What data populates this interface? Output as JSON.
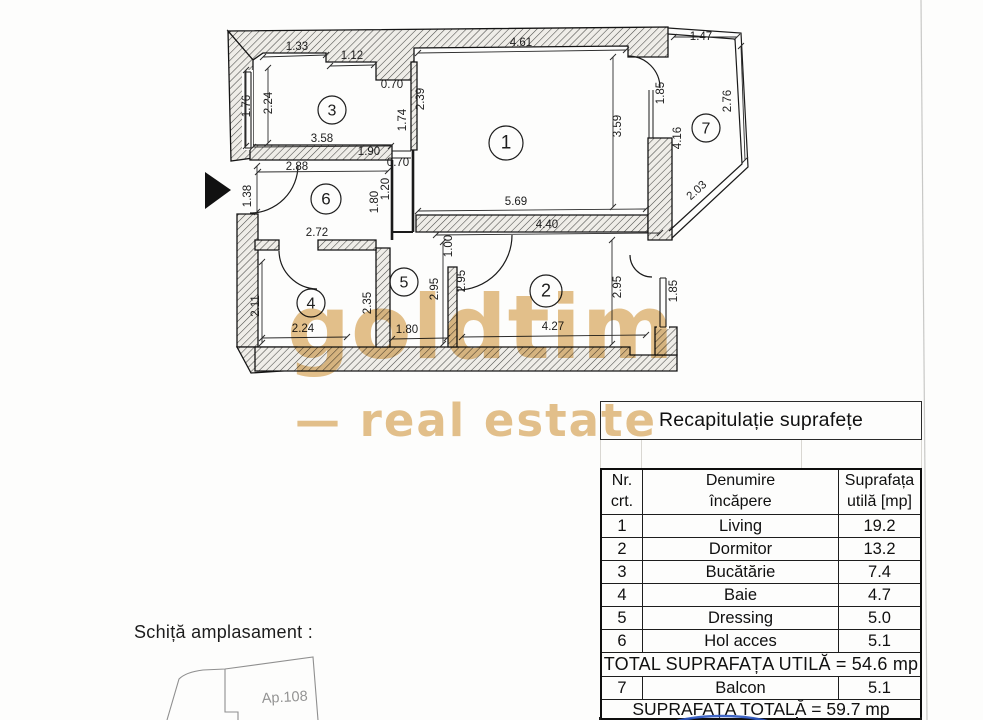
{
  "watermark": {
    "brand": "goldtim",
    "tagline": "— real estate",
    "color": "#e2bd83"
  },
  "floorplan": {
    "rooms": [
      {
        "n": "1",
        "x": 506,
        "y": 143,
        "r": 17
      },
      {
        "n": "2",
        "x": 546,
        "y": 291,
        "r": 16
      },
      {
        "n": "3",
        "x": 332,
        "y": 110,
        "r": 14
      },
      {
        "n": "4",
        "x": 311,
        "y": 303,
        "r": 14
      },
      {
        "n": "5",
        "x": 404,
        "y": 282,
        "r": 14
      },
      {
        "n": "6",
        "x": 326,
        "y": 199,
        "r": 15
      },
      {
        "n": "7",
        "x": 706,
        "y": 128,
        "r": 14
      }
    ],
    "dimensions": [
      {
        "t": "1.33",
        "x": 297,
        "y": 50,
        "a": 0
      },
      {
        "t": "1.12",
        "x": 352,
        "y": 59,
        "a": 0
      },
      {
        "t": "0.70",
        "x": 392,
        "y": 88,
        "a": 0
      },
      {
        "t": "2.39",
        "x": 424,
        "y": 99,
        "a": -90
      },
      {
        "t": "2.24",
        "x": 272,
        "y": 103,
        "a": -90
      },
      {
        "t": "1.76",
        "x": 250,
        "y": 106,
        "a": -90
      },
      {
        "t": "1.74",
        "x": 406,
        "y": 120,
        "a": -90
      },
      {
        "t": "3.58",
        "x": 322,
        "y": 142,
        "a": 0
      },
      {
        "t": "1.90",
        "x": 369,
        "y": 155,
        "a": 0
      },
      {
        "t": "2.88",
        "x": 297,
        "y": 170,
        "a": 0
      },
      {
        "t": "0.70",
        "x": 398,
        "y": 166,
        "a": 0
      },
      {
        "t": "4.61",
        "x": 521,
        "y": 46,
        "a": 0
      },
      {
        "t": "3.59",
        "x": 621,
        "y": 126,
        "a": -90
      },
      {
        "t": "5.69",
        "x": 516,
        "y": 205,
        "a": 0
      },
      {
        "t": "1.47",
        "x": 701,
        "y": 40,
        "a": 0
      },
      {
        "t": "1.85",
        "x": 664,
        "y": 93,
        "a": -90
      },
      {
        "t": "2.76",
        "x": 731,
        "y": 101,
        "a": -90
      },
      {
        "t": "4.16",
        "x": 681,
        "y": 138,
        "a": -90
      },
      {
        "t": "2.03",
        "x": 699,
        "y": 193,
        "a": -42
      },
      {
        "t": "1.38",
        "x": 251,
        "y": 196,
        "a": -90
      },
      {
        "t": "1.20",
        "x": 389,
        "y": 189,
        "a": -90
      },
      {
        "t": "1.80",
        "x": 378,
        "y": 202,
        "a": -90
      },
      {
        "t": "2.72",
        "x": 317,
        "y": 236,
        "a": 0
      },
      {
        "t": "4.40",
        "x": 547,
        "y": 228,
        "a": 0
      },
      {
        "t": "1.00",
        "x": 452,
        "y": 246,
        "a": -90
      },
      {
        "t": "2.11",
        "x": 259,
        "y": 306,
        "a": -90
      },
      {
        "t": "2.24",
        "x": 303,
        "y": 332,
        "a": 0
      },
      {
        "t": "2.35",
        "x": 371,
        "y": 303,
        "a": -90
      },
      {
        "t": "1.80",
        "x": 407,
        "y": 333,
        "a": 0
      },
      {
        "t": "2.95",
        "x": 438,
        "y": 289,
        "a": -90
      },
      {
        "t": "2.95",
        "x": 465,
        "y": 281,
        "a": -90
      },
      {
        "t": "2.95",
        "x": 621,
        "y": 287,
        "a": -90
      },
      {
        "t": "1.85",
        "x": 677,
        "y": 291,
        "a": -90
      },
      {
        "t": "4.27",
        "x": 553,
        "y": 330,
        "a": 0
      }
    ],
    "leaders": [
      [
        418,
        53,
        626,
        50
      ],
      [
        418,
        211,
        646,
        209
      ],
      [
        436,
        235,
        660,
        233
      ],
      [
        462,
        337,
        646,
        335
      ],
      [
        613,
        57,
        613,
        207
      ],
      [
        612,
        240,
        612,
        344
      ],
      [
        674,
        37,
        737,
        37
      ],
      [
        741,
        46,
        745,
        160
      ],
      [
        263,
        57,
        326,
        55
      ],
      [
        330,
        66,
        374,
        65
      ],
      [
        268,
        68,
        268,
        143
      ],
      [
        246,
        70,
        246,
        146
      ],
      [
        262,
        262,
        262,
        343
      ],
      [
        262,
        338,
        347,
        337
      ],
      [
        392,
        339,
        447,
        338
      ],
      [
        253,
        147,
        391,
        146
      ],
      [
        258,
        172,
        388,
        171
      ],
      [
        443,
        242,
        443,
        344
      ],
      [
        257,
        166,
        257,
        212
      ]
    ],
    "entrance_arrow": {
      "points": "205,172 231,190 205,209"
    },
    "site_apartment": "Ap.108"
  },
  "site": {
    "label": "Schiță amplasament :"
  },
  "table": {
    "title": "Recapitulație suprafețe",
    "headers": {
      "col1": [
        "Nr.",
        "crt."
      ],
      "col2": [
        "Denumire",
        "încăpere"
      ],
      "col3": [
        "Suprafața",
        "utilă [mp]"
      ]
    },
    "rows": [
      {
        "nr": "1",
        "name": "Living",
        "area": "19.2"
      },
      {
        "nr": "2",
        "name": "Dormitor",
        "area": "13.2"
      },
      {
        "nr": "3",
        "name": "Bucătărie",
        "area": "7.4"
      },
      {
        "nr": "4",
        "name": "Baie",
        "area": "4.7"
      },
      {
        "nr": "5",
        "name": "Dressing",
        "area": "5.0"
      },
      {
        "nr": "6",
        "name": "Hol acces",
        "area": "5.1"
      }
    ],
    "total_util": "TOTAL SUPRAFAȚA UTILĂ = 54.6 mp",
    "balcony_row": {
      "nr": "7",
      "name": "Balcon",
      "area": "5.1"
    },
    "total_all": "SUPRAFAȚA TOTALĂ = 59.7 mp"
  },
  "annotations": {
    "pen_color": "#2b55c0"
  }
}
